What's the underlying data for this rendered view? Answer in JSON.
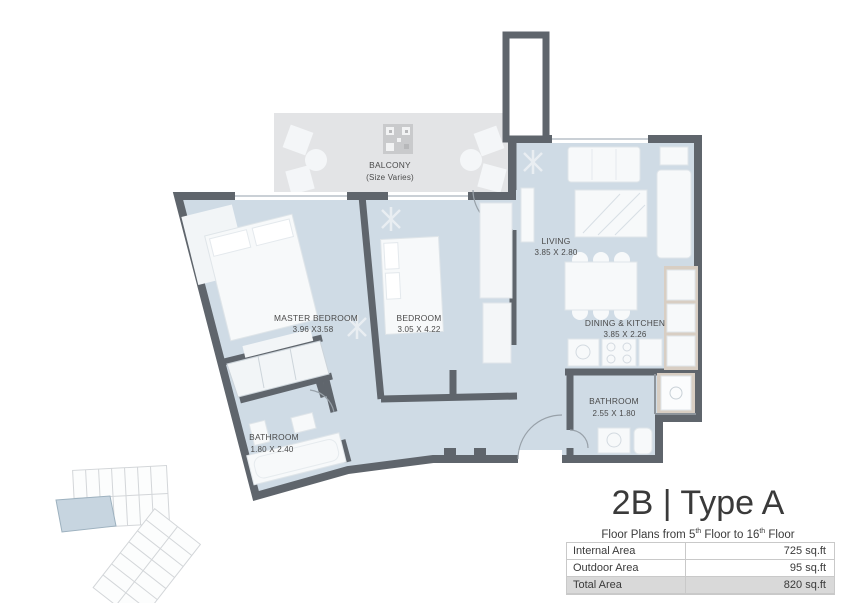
{
  "plan": {
    "balcony": {
      "name": "BALCONY",
      "size": "(Size Varies)"
    },
    "rooms": [
      {
        "id": "living",
        "name": "LIVING",
        "dims": "3.85 X 2.80"
      },
      {
        "id": "master-bedroom",
        "name": "MASTER BEDROOM",
        "dims": "3.96 X3.58"
      },
      {
        "id": "bedroom",
        "name": "BEDROOM",
        "dims": "3.05 X 4.22"
      },
      {
        "id": "dining-kitchen",
        "name": "DINING & KITCHEN",
        "dims": "3.85 X 2.26"
      },
      {
        "id": "bathroom-right",
        "name": "BATHROOM",
        "dims": "2.55 X 1.80"
      },
      {
        "id": "bathroom-left",
        "name": "BATHROOM",
        "dims": "1.80 X 2.40"
      }
    ]
  },
  "info": {
    "title": "2B | Type A",
    "subtitle": {
      "p1": "Floor Plans from 5",
      "sup1": "th",
      "p2": " Floor to 16",
      "sup2": "th",
      "p3": " Floor"
    },
    "table": {
      "rows": [
        {
          "label": "Internal Area",
          "value": "725 sq.ft"
        },
        {
          "label": "Outdoor Area",
          "value": "95 sq.ft"
        },
        {
          "label": "Total Area",
          "value": "820 sq.ft"
        }
      ]
    }
  },
  "colors": {
    "wall": "#5f656c",
    "floor": "#cfdbe5",
    "balcony": "#e3e4e6",
    "accent_beige": "#d8cec3",
    "furniture": "#f7f9fa",
    "highlight_unit": "#c7d5e0",
    "total_row_bg": "#d9d9d9"
  }
}
